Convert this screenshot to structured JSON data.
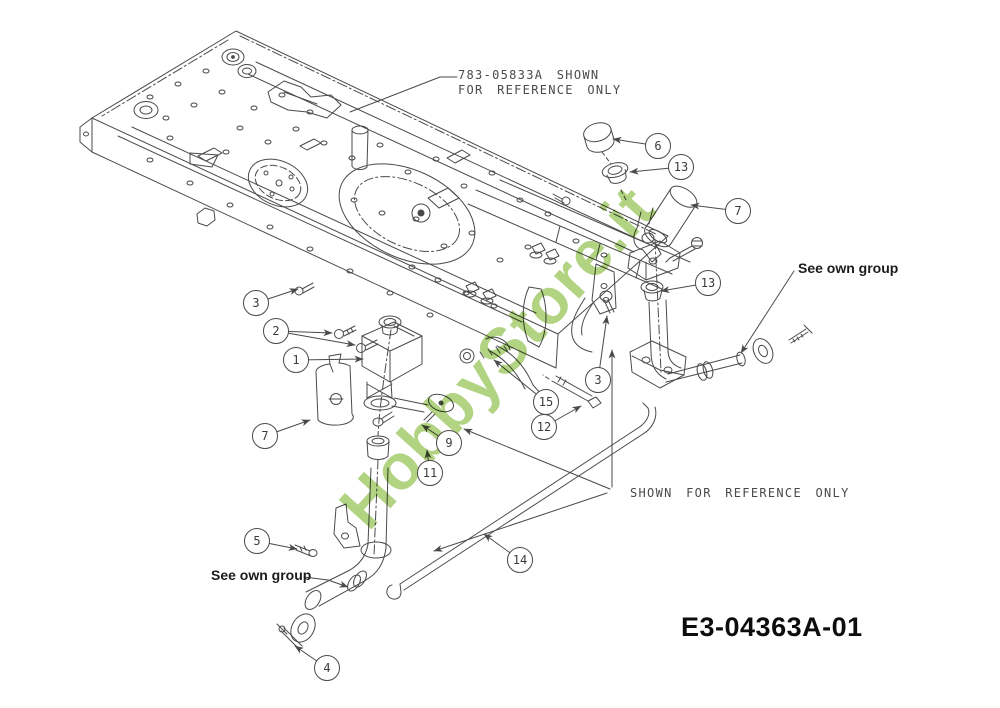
{
  "page": {
    "background_color": "#ffffff"
  },
  "diagram": {
    "drawing_number": "E3-04363A-01",
    "watermark": {
      "text": "HobbyStore.it",
      "color": "#a3cb6c"
    },
    "line_color": "#4a4a4a",
    "notes": {
      "top_reference": {
        "line1": "783-05833A SHOWN",
        "line2": "FOR REFERENCE ONLY"
      },
      "middle_reference": {
        "text": "SHOWN FOR REFERENCE ONLY"
      },
      "see_own_group_right": {
        "text": "See own group"
      },
      "see_own_group_left": {
        "text": "See own group"
      }
    },
    "callouts": [
      {
        "number": "6"
      },
      {
        "number": "13"
      },
      {
        "number": "7"
      },
      {
        "number": "3"
      },
      {
        "number": "2"
      },
      {
        "number": "1"
      },
      {
        "number": "13"
      },
      {
        "number": "7"
      },
      {
        "number": "3"
      },
      {
        "number": "15"
      },
      {
        "number": "12"
      },
      {
        "number": "9"
      },
      {
        "number": "11"
      },
      {
        "number": "5"
      },
      {
        "number": "14"
      },
      {
        "number": "4"
      }
    ]
  }
}
